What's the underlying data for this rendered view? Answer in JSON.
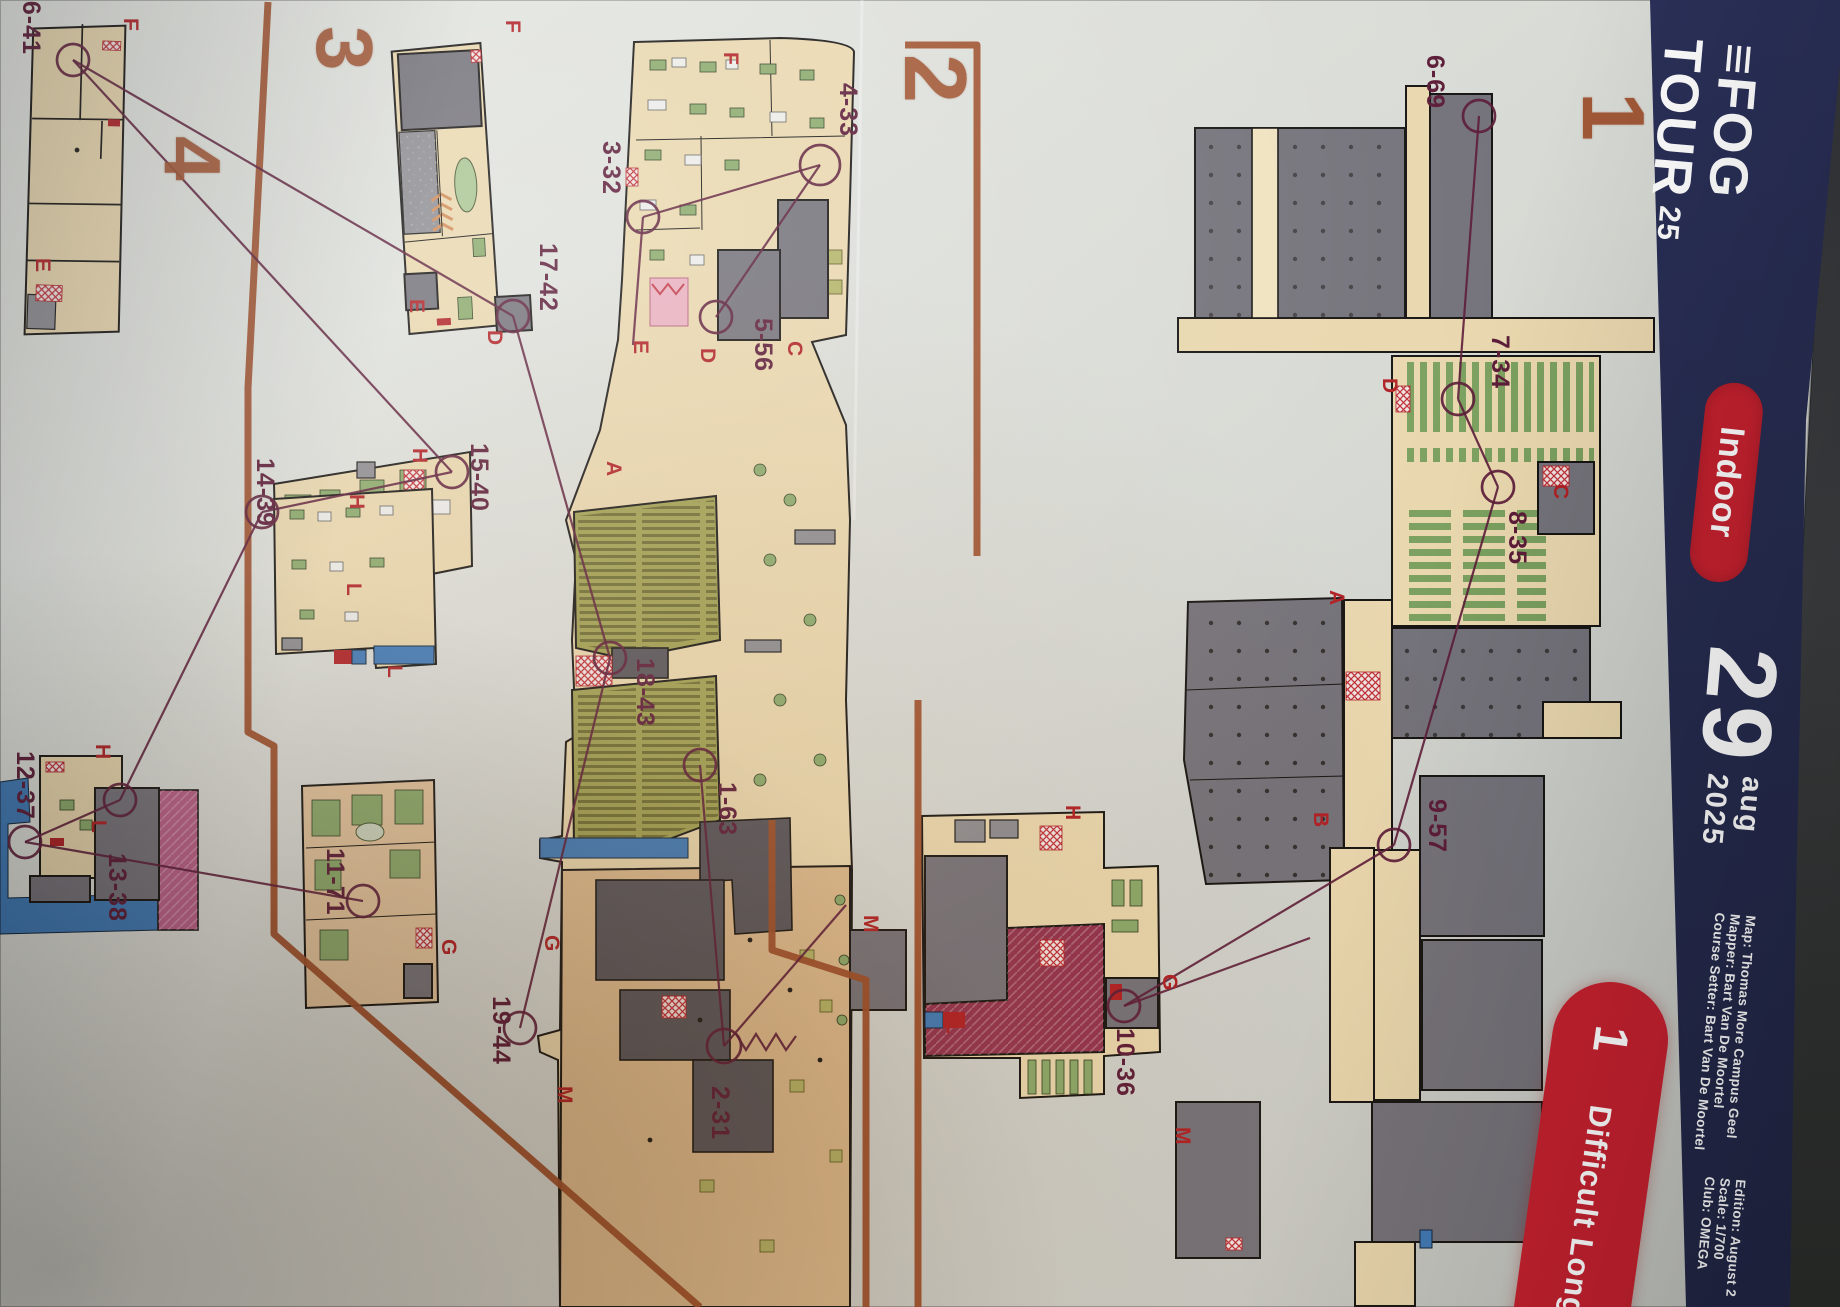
{
  "colors": {
    "paper": "#d6d8d3",
    "navy": "#272d52",
    "red": "#c6212f",
    "purple": "#5c1c38",
    "copper": "#9d4e2a",
    "letter": "#b02025",
    "tan": "#e9d7ae",
    "gray": "#74727a",
    "green": "#8aa96b",
    "olive": "#a0a052",
    "crimson": "#93334f",
    "magenta": "#bb6089",
    "blue": "#3f7ab8",
    "warm": "#dcba8e"
  },
  "banner": {
    "logo": {
      "bars": "≡",
      "line1": "FOG",
      "line2": "TOUR",
      "year": "25"
    },
    "badge": "Indoor",
    "date": {
      "day": "29",
      "month": "aug",
      "year": "2025"
    },
    "credits": [
      "Map: Thomas More Campus Geel",
      "Mapper: Bart Van De Moortel",
      "Course Setter: Bart Van De Moortel"
    ],
    "details": [
      "Edition: August 2",
      "Scale: 1/700",
      "Club: OMEGA"
    ]
  },
  "course_badge": {
    "number": "1",
    "name": "Difficult Long"
  },
  "sections": [
    {
      "n": "1",
      "x": 1562,
      "y": 92,
      "s": 88
    },
    {
      "n": "2",
      "x": 884,
      "y": 54,
      "s": 88
    },
    {
      "n": "3",
      "x": 298,
      "y": 26,
      "s": 80
    },
    {
      "n": "4",
      "x": 146,
      "y": 136,
      "s": 80
    }
  ],
  "course": {
    "controls": [
      {
        "code": "1-63",
        "c": [
          700,
          765
        ],
        "l": [
          712,
          782
        ]
      },
      {
        "code": "2-31",
        "c": [
          724,
          1046
        ],
        "l": [
          705,
          1086
        ],
        "r": 17
      },
      {
        "code": "3-32",
        "c": [
          643,
          217
        ],
        "l": [
          596,
          141
        ]
      },
      {
        "code": "4-33",
        "c": [
          820,
          165
        ],
        "l": [
          833,
          83
        ],
        "r": 20
      },
      {
        "code": "5-56",
        "c": [
          716,
          317
        ],
        "l": [
          748,
          318
        ]
      },
      {
        "code": "6-69",
        "c": [
          1479,
          116
        ],
        "l": [
          1420,
          55
        ]
      },
      {
        "code": "7-34",
        "c": [
          1458,
          399
        ],
        "l": [
          1485,
          335
        ]
      },
      {
        "code": "8-35",
        "c": [
          1498,
          487
        ],
        "l": [
          1502,
          511
        ]
      },
      {
        "code": "9-57",
        "c": [
          1394,
          845
        ],
        "l": [
          1422,
          799
        ]
      },
      {
        "code": "10-36",
        "c": [
          1124,
          1006
        ],
        "l": [
          1110,
          1028
        ]
      },
      {
        "code": "11-71",
        "c": [
          363,
          901
        ],
        "l": [
          320,
          848
        ]
      },
      {
        "code": "12-37",
        "c": [
          25,
          842
        ],
        "l": [
          10,
          751
        ]
      },
      {
        "code": "13-38",
        "c": [
          120,
          800
        ],
        "l": [
          102,
          853
        ]
      },
      {
        "code": "14-39",
        "c": [
          262,
          512
        ],
        "l": [
          250,
          458
        ]
      },
      {
        "code": "15-40",
        "c": [
          452,
          472
        ],
        "l": [
          464,
          443
        ]
      },
      {
        "code": "16-41",
        "c": [
          73,
          60
        ],
        "l": [
          16,
          -14
        ]
      },
      {
        "code": "17-42",
        "c": [
          513,
          316
        ],
        "l": [
          533,
          243
        ]
      },
      {
        "code": "18-43",
        "c": [
          610,
          658
        ],
        "l": [
          630,
          658
        ]
      },
      {
        "code": "19-44",
        "c": [
          520,
          1028
        ],
        "l": [
          486,
          996
        ]
      }
    ],
    "letters": [
      {
        "t": "F",
        "x": 118,
        "y": 18
      },
      {
        "t": "E",
        "x": 30,
        "y": 258
      },
      {
        "t": "F",
        "x": 500,
        "y": 20
      },
      {
        "t": "E",
        "x": 404,
        "y": 299
      },
      {
        "t": "H",
        "x": 407,
        "y": 448
      },
      {
        "t": "L",
        "x": 341,
        "y": 583
      },
      {
        "t": "H",
        "x": 90,
        "y": 744
      },
      {
        "t": "L",
        "x": 86,
        "y": 820
      },
      {
        "t": "H",
        "x": 344,
        "y": 494
      },
      {
        "t": "L",
        "x": 382,
        "y": 665
      },
      {
        "t": "G",
        "x": 436,
        "y": 939
      },
      {
        "t": "F",
        "x": 718,
        "y": 52
      },
      {
        "t": "E",
        "x": 628,
        "y": 340
      },
      {
        "t": "D",
        "x": 695,
        "y": 348
      },
      {
        "t": "C",
        "x": 782,
        "y": 341
      },
      {
        "t": "A",
        "x": 601,
        "y": 461
      },
      {
        "t": "D",
        "x": 482,
        "y": 330
      },
      {
        "t": "G",
        "x": 539,
        "y": 935
      },
      {
        "t": "M",
        "x": 552,
        "y": 1086
      },
      {
        "t": "D",
        "x": 1377,
        "y": 378
      },
      {
        "t": "C",
        "x": 1548,
        "y": 484
      },
      {
        "t": "A",
        "x": 1324,
        "y": 590
      },
      {
        "t": "B",
        "x": 1308,
        "y": 812
      },
      {
        "t": "G",
        "x": 1157,
        "y": 974
      },
      {
        "t": "M",
        "x": 1170,
        "y": 1127
      },
      {
        "t": "H",
        "x": 1060,
        "y": 805
      },
      {
        "t": "L",
        "x": 941,
        "y": 1021
      },
      {
        "t": "M",
        "x": 858,
        "y": 915
      }
    ],
    "legs": [
      [
        73,
        60,
        513,
        316
      ],
      [
        73,
        60,
        452,
        472
      ],
      [
        513,
        316,
        610,
        658
      ],
      [
        262,
        512,
        452,
        472
      ],
      [
        120,
        800,
        262,
        512
      ],
      [
        25,
        842,
        120,
        800
      ],
      [
        363,
        901,
        25,
        842
      ],
      [
        610,
        658,
        520,
        1028
      ],
      [
        700,
        765,
        724,
        1046
      ],
      [
        724,
        1046,
        846,
        905
      ],
      [
        643,
        217,
        633,
        345
      ],
      [
        820,
        165,
        643,
        217
      ],
      [
        820,
        165,
        716,
        317
      ],
      [
        1479,
        116,
        1458,
        399
      ],
      [
        1458,
        399,
        1498,
        487
      ],
      [
        1498,
        487,
        1394,
        845
      ],
      [
        1394,
        845,
        1124,
        1006
      ],
      [
        1124,
        1006,
        1310,
        938
      ]
    ],
    "finish_marks": "M736,1034 l10,16 l10,-16 l10,16 l10,-16 l10,16 l10,-14",
    "dividers": [
      "M905,45 L977,45 L977,556",
      "M918,700 L918,1307",
      "M268,2 L248,388 L248,732 L274,746 L274,934 L700,1307",
      "M772,820 L772,950 L866,980 L866,1307"
    ]
  }
}
